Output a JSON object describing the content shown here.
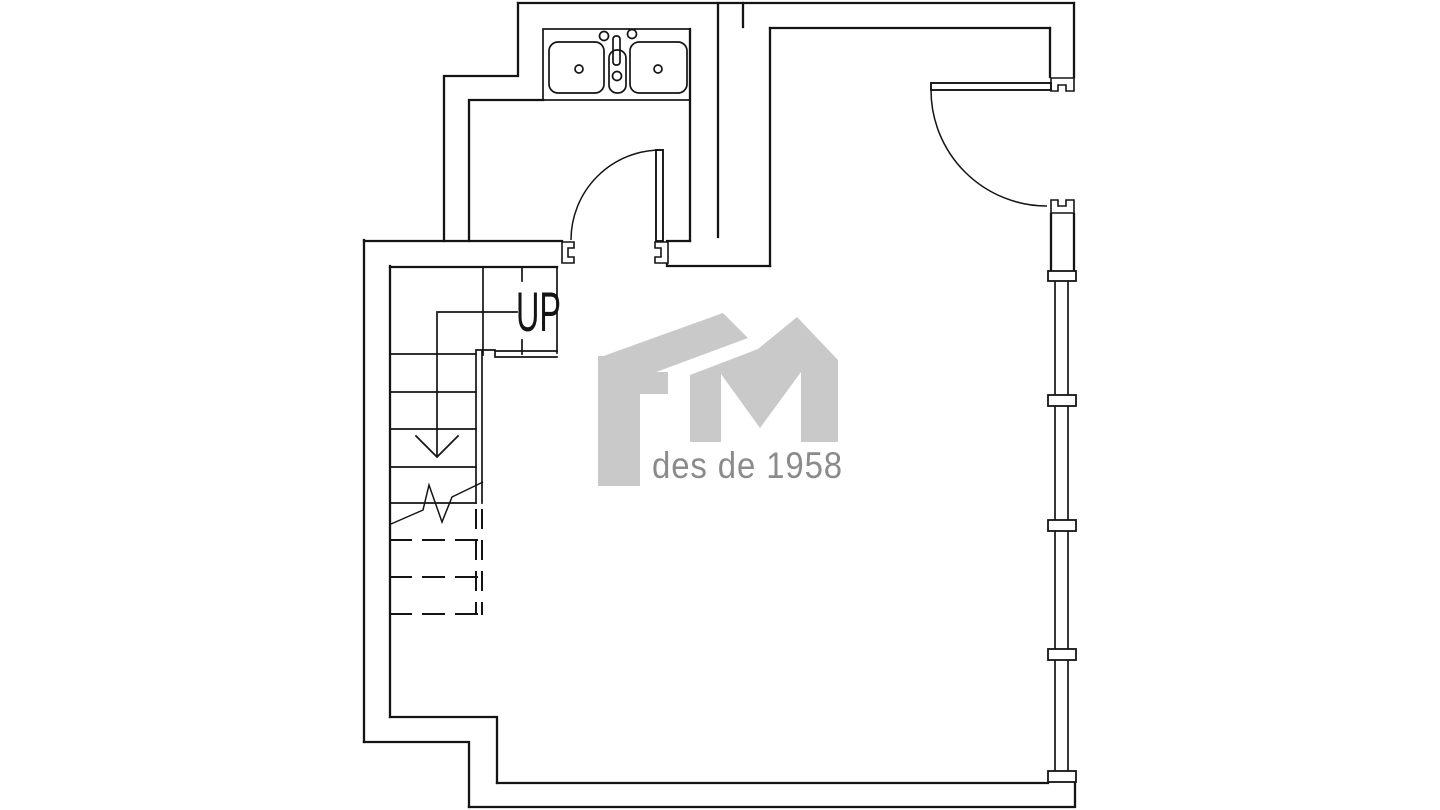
{
  "colors": {
    "background": "#ffffff",
    "line": "#141414",
    "watermark": "#c9c9c9",
    "watermark_text": "#8b8b8b"
  },
  "plan": {
    "stair_label": "UP",
    "watermark_letters": "FM",
    "watermark_tagline": "des de 1958",
    "icons": [
      "double-sink-icon",
      "faucet-icon",
      "door-swing-icon",
      "window-band-icon",
      "stair-direction-arrow-icon",
      "break-line-icon"
    ]
  }
}
